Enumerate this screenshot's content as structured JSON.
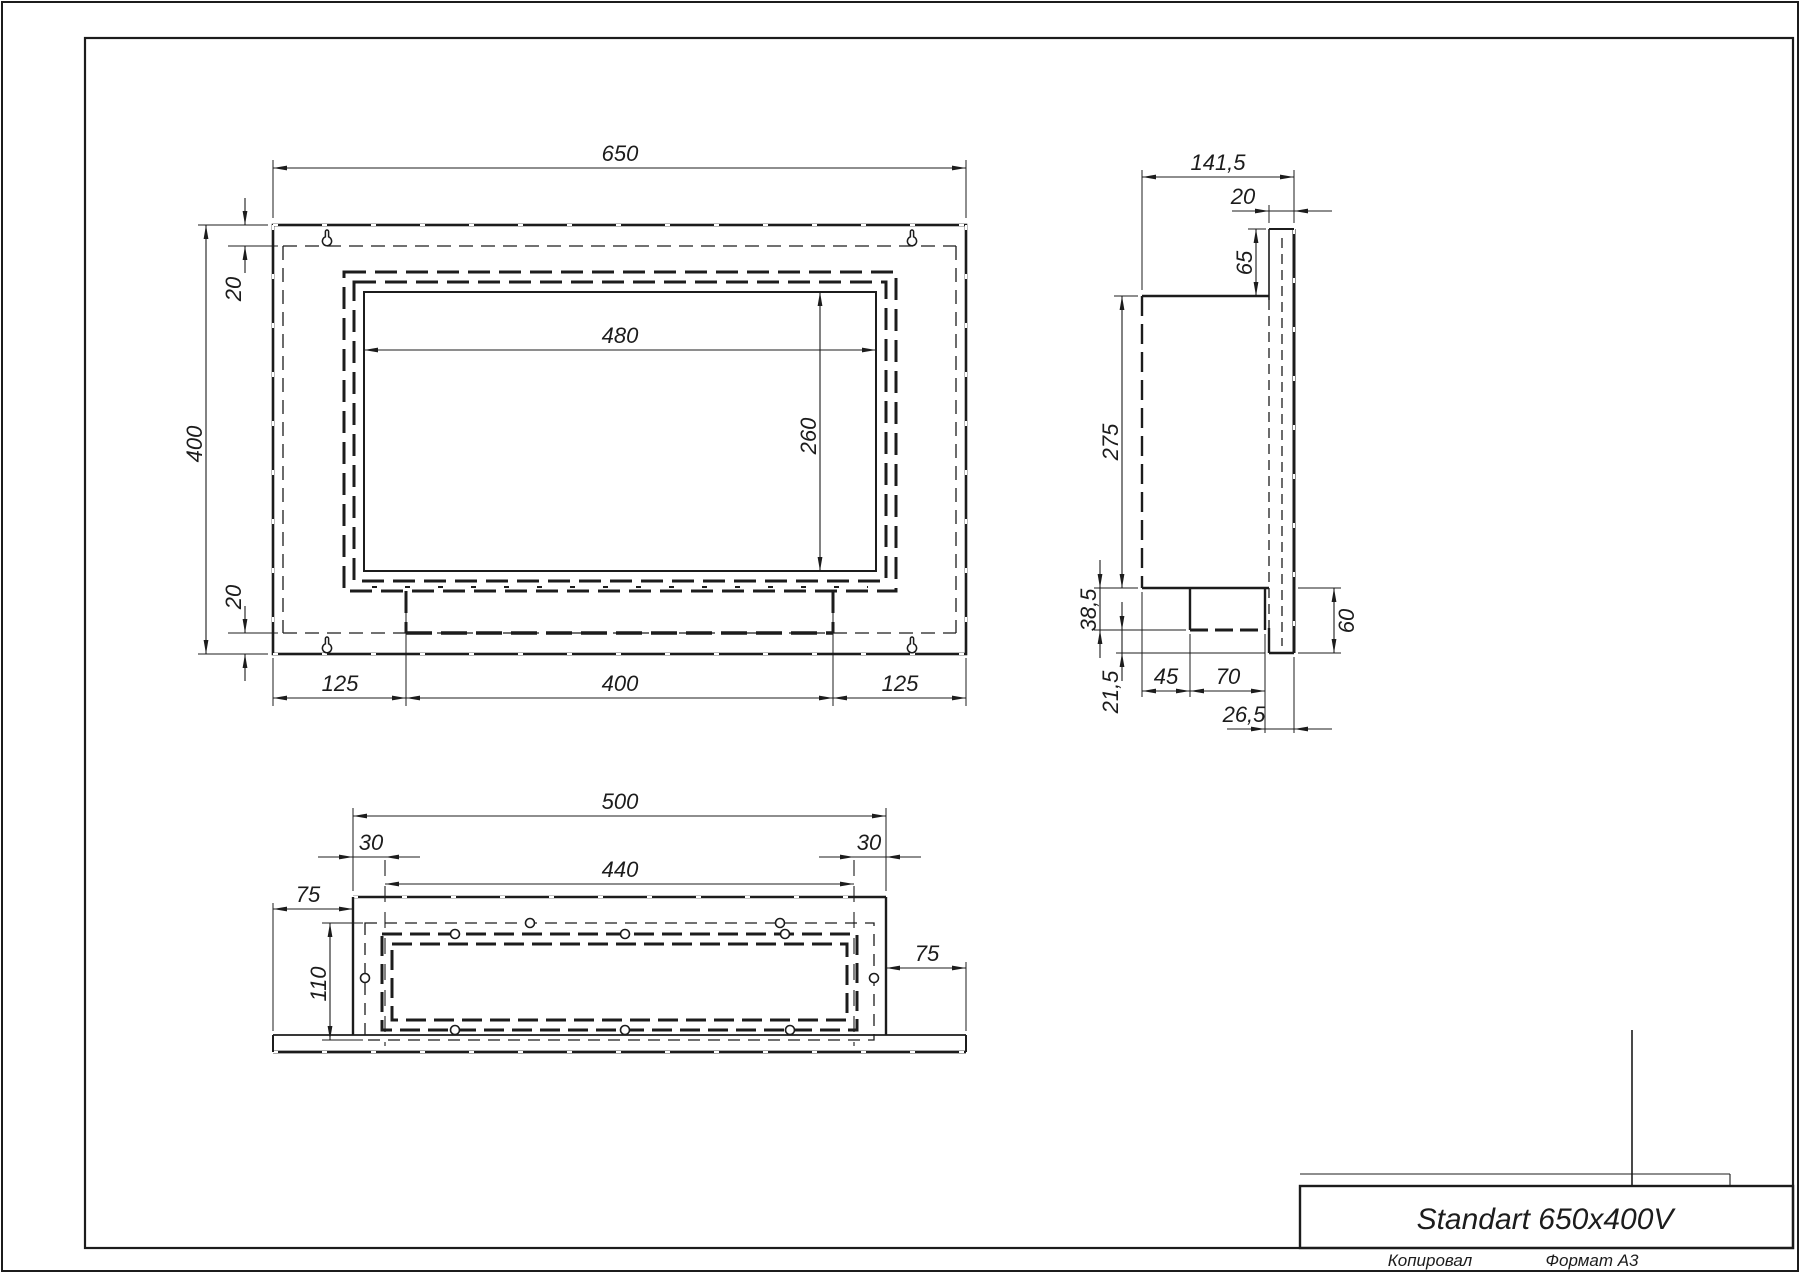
{
  "front_view": {
    "dims": {
      "total_width": "650",
      "total_height": "400",
      "top_flange": "20",
      "bottom_flange": "20",
      "opening_width": "480",
      "opening_height": "260",
      "bottom_left_segment": "125",
      "bottom_center_segment": "400",
      "bottom_right_segment": "125"
    }
  },
  "side_view": {
    "dims": {
      "total_depth": "141,5",
      "flange_thickness": "20",
      "flange_top_overhang": "65",
      "body_height": "275",
      "tray_height": "38,5",
      "bottom_overhang": "21,5",
      "tray_offset": "45",
      "tray_depth": "70",
      "tray_edge_offset": "26,5",
      "flange_bottom_drop": "60"
    }
  },
  "bottom_view": {
    "dims": {
      "body_width": "500",
      "inset_left": "30",
      "inset_right": "30",
      "opening_width": "440",
      "flange_left": "75",
      "flange_right": "75",
      "depth": "110"
    }
  },
  "title_block": {
    "title": "Standart 650x400V",
    "copied_label": "Копировал",
    "format_label": "Формат A3"
  }
}
